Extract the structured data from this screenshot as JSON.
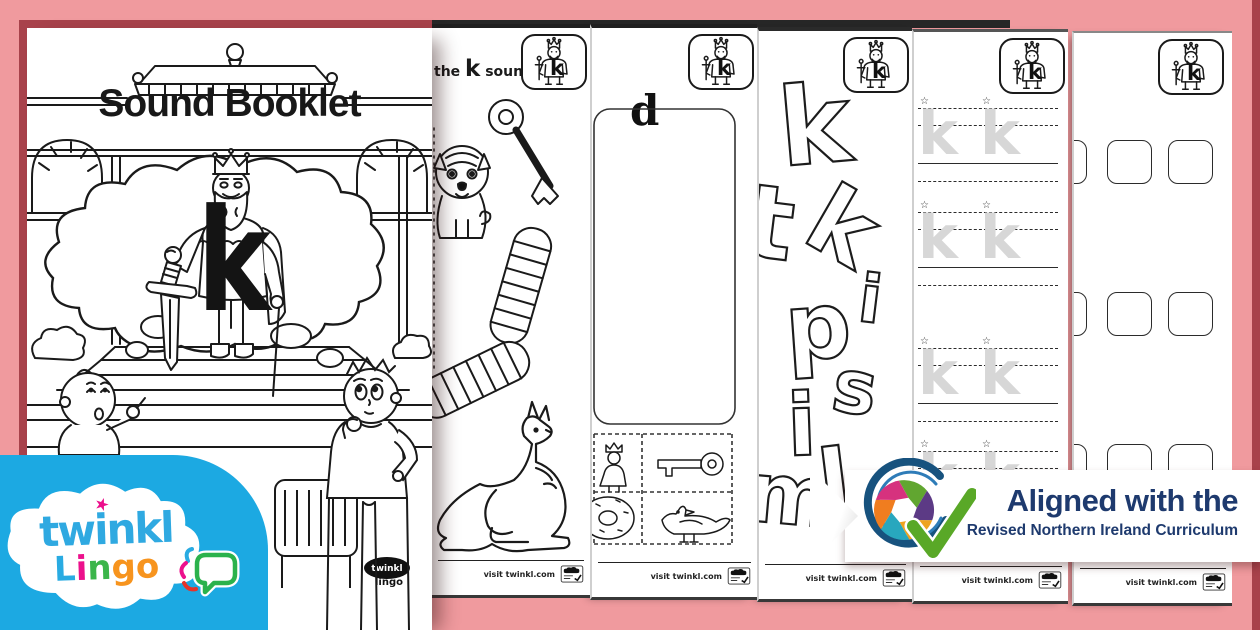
{
  "colors": {
    "background_pink": "#F09A9E",
    "edge_red": "#A8424B",
    "ink": "#1A1A1A",
    "panel_blue": "#1CA9E2",
    "brand_blue": "#2FA9E1",
    "star_pink": "#EC108C",
    "navy": "#1E3A6E",
    "check_green": "#59A827",
    "swoosh_blue": "#17527E",
    "trace_gray": "#D7D7D7",
    "lingo_colors": [
      "#29ABE2",
      "#EC108C",
      "#3BB54A",
      "#F7941E",
      "#F7941E"
    ],
    "shutter": {
      "pink": "#D6327E",
      "green": "#61A630",
      "purple": "#5C3A85",
      "gold": "#EFA31F",
      "teal": "#28A7BE",
      "orange": "#F07D1F"
    }
  },
  "cover": {
    "title": "Sound Booklet",
    "big_letter": "k",
    "bench_sticker_brand": "twinkl",
    "bench_sticker_product": "lingo"
  },
  "king_badge": {
    "letter": "k"
  },
  "footer": {
    "text": "visit twinkl.com"
  },
  "page2": {
    "instruction_prefix": "the",
    "instruction_letter": "k",
    "instruction_suffix": "sound."
  },
  "page3": {
    "column_label": "d"
  },
  "page4": {
    "letters": [
      "k",
      "t",
      "k",
      "i",
      "p",
      "s",
      "i",
      "m",
      "l"
    ]
  },
  "page5": {
    "trace_letter": "k",
    "star_icon": "☆"
  },
  "logo": {
    "brand": "twinkl",
    "star_icon": "★",
    "product_letters": [
      "L",
      "i",
      "n",
      "g",
      "o"
    ]
  },
  "ribbon": {
    "line1": "Aligned with the",
    "line2": "Revised Northern Ireland Curriculum"
  }
}
